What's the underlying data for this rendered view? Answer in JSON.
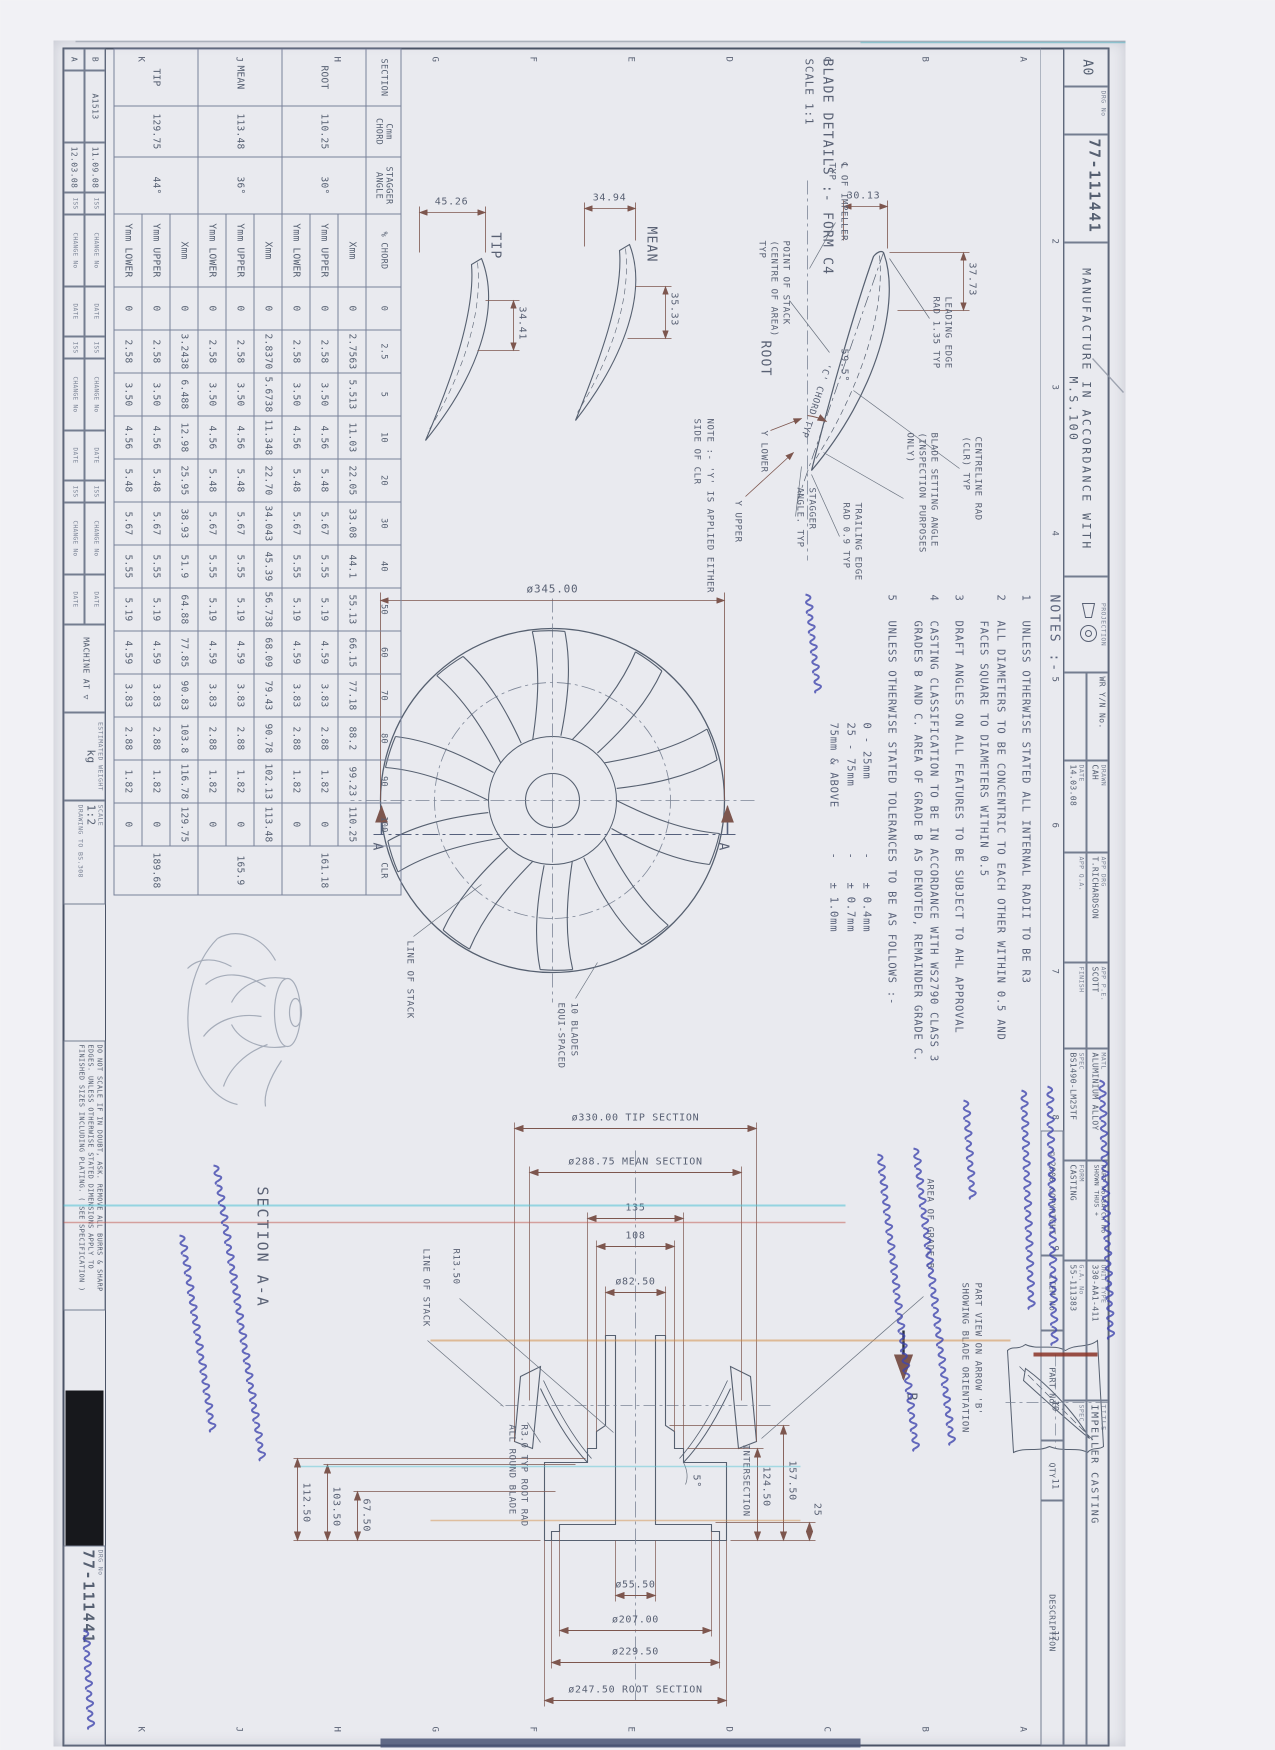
{
  "sheet": {
    "size": "A0",
    "drg_label": "DRG No",
    "drg_no": "77-111441",
    "manufacture": "MANUFACTURE IN ACCORDANCE WITH M.S.100",
    "projection": "PROJECTION",
    "copyright": "© 2008 COPYRIGHT",
    "item_no": "ITEM No",
    "part_no": "PART No",
    "qty": "QTY",
    "description": "DESCRIPTION",
    "wr": "WR Y/N No.",
    "border_numbers": [
      "2",
      "3",
      "4",
      "5",
      "6",
      "7",
      "8",
      "9",
      "10",
      "11",
      "12"
    ],
    "border_letters": [
      "A",
      "B",
      "C",
      "D",
      "E",
      "F",
      "G",
      "H",
      "J",
      "K"
    ]
  },
  "title_block": {
    "drawn_label": "DRAWN",
    "drawn": "CAH",
    "date_label": "DATE",
    "date": "14.03.08",
    "app_drg_label": "APP DRG",
    "app_drg": "T.RICHARDSON",
    "app_pe_label": "APP P.E.",
    "app_pe": "SCOTT",
    "app_qa_label": "APP Q.A.",
    "matl_label": "MATL",
    "matl": "ALUMINIUM ALLOY",
    "spec_label": "SPEC",
    "spec": "BS1490-LM25TF",
    "form_label": "FORM",
    "form": "CASTING",
    "finish_label": "FINISH",
    "spec2_label": "SPEC",
    "part_batch": "PART No/BATCH No SHOWN THUS +",
    "title_label": "TITLE",
    "title": "IMPELLER CASTING",
    "unit_label": "UNIT TYPE",
    "unit": "330-AA1-411",
    "ga_label": "G.A. No",
    "ga": "55-111383"
  },
  "revision": {
    "headers": [
      "ISS",
      "CHANGE No",
      "DATE"
    ],
    "rows": [
      {
        "iss": "B",
        "change": "A1513",
        "date": "11.09.08"
      },
      {
        "iss": "A",
        "change": "",
        "date": "12.03.08"
      }
    ]
  },
  "bottom_strip": {
    "do_not_scale": "DO NOT SCALE IF IN DOUBT, ASK. REMOVE ALL BURRS & SHARP EDGES. UNLESS OTHERWISE STATED DIMENSIONS APPLY TO FINISHED SIZES INCLUDING PLATING. ( SEE SPECIFICATION )",
    "machine_at": "MACHINE AT ▽",
    "scale_label": "SCALE",
    "scale": "1:2",
    "drawing_to": "DRAWING TO BS.308",
    "est_weight_label": "ESTIMATED WEIGHT",
    "est_weight_unit": "kg",
    "drg_label": "DRG No",
    "drg_no": "77-111441"
  },
  "blade_details": {
    "heading": "BLADE DETAILS :- FORM C4",
    "scale": "SCALE 1:1",
    "labels": {
      "cl": [
        "℄ OF IMPELLER",
        "TYP"
      ],
      "stack": [
        "POINT OF STACK",
        "(CENTRE OF AREA)",
        "TYP"
      ],
      "leading": [
        "LEADING EDGE",
        "RAD 1.35 TYP"
      ],
      "clr": [
        "CENTRELINE RAD",
        "(CLR) TYP"
      ],
      "setting": [
        "BLADE SETTING ANGLE",
        "(INSPECTION PURPOSES",
        "ONLY)"
      ],
      "cchord": "'C' CHORD TYP",
      "trailing": [
        "TRAILING EDGE",
        "RAD 0.9 TYP"
      ],
      "stagger": [
        "STAGGER",
        "ANGLE. TYP"
      ],
      "ylower": "Y LOWER",
      "yupper": "Y UPPER",
      "ynote": [
        "NOTE :- 'Y' IS APPLIED EITHER",
        "SIDE OF CLR"
      ],
      "angle": "59.5°"
    },
    "profiles": [
      {
        "name": "ROOT",
        "w": "37.73",
        "h": "30.13"
      },
      {
        "name": "MEAN",
        "w": "35.33",
        "h": "34.94"
      },
      {
        "name": "TIP",
        "w": "34.41",
        "h": "45.26"
      }
    ]
  },
  "blade_table": {
    "corner": [
      "SECTION",
      "Cmm CHORD",
      "STAGGER ANGLE"
    ],
    "pct_label": "% CHORD",
    "cols": [
      "0",
      "2.5",
      "5",
      "10",
      "20",
      "30",
      "40",
      "50",
      "60",
      "70",
      "80",
      "90",
      "100"
    ],
    "clr": "CLR",
    "sections": [
      {
        "name": "ROOT",
        "chord": "110.25",
        "stagger": "30°",
        "clr": "161.18",
        "rows": [
          {
            "label": "Xmm",
            "values": [
              "0",
              "2.7563",
              "5.513",
              "11.03",
              "22.05",
              "33.08",
              "44.1",
              "55.13",
              "66.15",
              "77.18",
              "88.2",
              "99.23",
              "110.25"
            ]
          },
          {
            "label": "Ymm UPPER",
            "values": [
              "0",
              "2.58",
              "3.50",
              "4.56",
              "5.48",
              "5.67",
              "5.55",
              "5.19",
              "4.59",
              "3.83",
              "2.88",
              "1.82",
              "0"
            ]
          },
          {
            "label": "Ymm LOWER",
            "values": [
              "0",
              "2.58",
              "3.50",
              "4.56",
              "5.48",
              "5.67",
              "5.55",
              "5.19",
              "4.59",
              "3.83",
              "2.88",
              "1.82",
              "0"
            ]
          }
        ]
      },
      {
        "name": "MEAN",
        "chord": "113.48",
        "stagger": "36°",
        "clr": "165.9",
        "rows": [
          {
            "label": "Xmm",
            "values": [
              "0",
              "2.8370",
              "5.6738",
              "11.348",
              "22.70",
              "34.043",
              "45.39",
              "56.738",
              "68.09",
              "79.43",
              "90.78",
              "102.13",
              "113.48"
            ]
          },
          {
            "label": "Ymm UPPER",
            "values": [
              "0",
              "2.58",
              "3.50",
              "4.56",
              "5.48",
              "5.67",
              "5.55",
              "5.19",
              "4.59",
              "3.83",
              "2.88",
              "1.82",
              "0"
            ]
          },
          {
            "label": "Ymm LOWER",
            "values": [
              "0",
              "2.58",
              "3.50",
              "4.56",
              "5.48",
              "5.67",
              "5.55",
              "5.19",
              "4.59",
              "3.83",
              "2.88",
              "1.82",
              "0"
            ]
          }
        ]
      },
      {
        "name": "TIP",
        "chord": "129.75",
        "stagger": "44°",
        "clr": "189.68",
        "rows": [
          {
            "label": "Xmm",
            "values": [
              "0",
              "3.2438",
              "6.488",
              "12.98",
              "25.95",
              "38.93",
              "51.9",
              "64.88",
              "77.85",
              "90.83",
              "103.8",
              "116.78",
              "129.75"
            ]
          },
          {
            "label": "Ymm UPPER",
            "values": [
              "0",
              "2.58",
              "3.50",
              "4.56",
              "5.48",
              "5.67",
              "5.55",
              "5.19",
              "4.59",
              "3.83",
              "2.88",
              "1.82",
              "0"
            ]
          },
          {
            "label": "Ymm LOWER",
            "values": [
              "0",
              "2.58",
              "3.50",
              "4.56",
              "5.48",
              "5.67",
              "5.55",
              "5.19",
              "4.59",
              "3.83",
              "2.88",
              "1.82",
              "0"
            ]
          }
        ]
      }
    ]
  },
  "front_view": {
    "dia": "ø345.00",
    "stack": "LINE OF STACK",
    "blades": [
      "10 BLADES",
      "EQUI-SPACED"
    ],
    "a": "A"
  },
  "notes": {
    "heading": "NOTES :-",
    "items": [
      {
        "num": "1",
        "text": "UNLESS OTHERWISE STATED ALL INTERNAL RADII TO BE R3"
      },
      {
        "num": "2",
        "text": "ALL DIAMETERS TO BE CONCENTRIC TO EACH OTHER WITHIN 0.5 AND FACES SQUARE TO DIAMETERS WITHIN 0.5"
      },
      {
        "num": "3",
        "text": "DRAFT ANGLES ON ALL FEATURES TO BE SUBJECT TO AHL APPROVAL"
      },
      {
        "num": "4",
        "text": "CASTING CLASSIFICATION TO BE IN ACCORDANCE WITH WS2790 CLASS 3 GRADES B AND C. AREA OF GRADE B AS DENOTED, REMAINDER GRADE C."
      },
      {
        "num": "5",
        "text": "UNLESS OTHERWISE STATED TOLERANCES TO BE AS FOLLOWS :-"
      }
    ],
    "tol": [
      {
        "r": "0 - 25mm",
        "d": "-",
        "v": "± 0.4mm"
      },
      {
        "r": "25 - 75mm",
        "d": "-",
        "v": "± 0.7mm"
      },
      {
        "r": "75mm & ABOVE",
        "d": "-",
        "v": "± 1.0mm"
      }
    ]
  },
  "section_view": {
    "title": "SECTION A-A",
    "tip": "ø330.00 TIP SECTION",
    "mean": "ø288.75 MEAN SECTION",
    "d135": "135",
    "d108": "108",
    "d82": "ø82.50",
    "d55": "ø55.50",
    "d207": "ø207.00",
    "d229": "ø229.50",
    "droot": "ø247.50 ROOT SECTION",
    "d112": "112.50",
    "d103": "103.50",
    "d67": "67.50",
    "d157": "157.50",
    "d124": "124.50",
    "intersection": "INTERSECTION",
    "d25": "25",
    "ang": "5°",
    "r13": "R13.50",
    "stack": "LINE OF STACK",
    "rootrad": [
      "R3.0 TYP ROOT RAD",
      "ALL ROUND BLADE"
    ],
    "gradeb": "AREA OF GRADE B",
    "b": "B"
  },
  "part_view": {
    "label": [
      "PART VIEW ON ARROW 'B'",
      "SHOWING BLADE ORIENTATION"
    ]
  },
  "handwritten": {
    "radii": "未注内部R角为R3.",
    "concentric": "各直径要保证同心度0.5,端面垂直.",
    "draft": "拔模斜度需联系AHL同意.",
    "casting": "铸造要求达到 WS2790 class 3 Grade B 和 C.",
    "tolerance": "未注公差:",
    "blade_shape": "叶片绘形",
    "material": "材料: 铝合金 BS1490-LM25TF"
  }
}
